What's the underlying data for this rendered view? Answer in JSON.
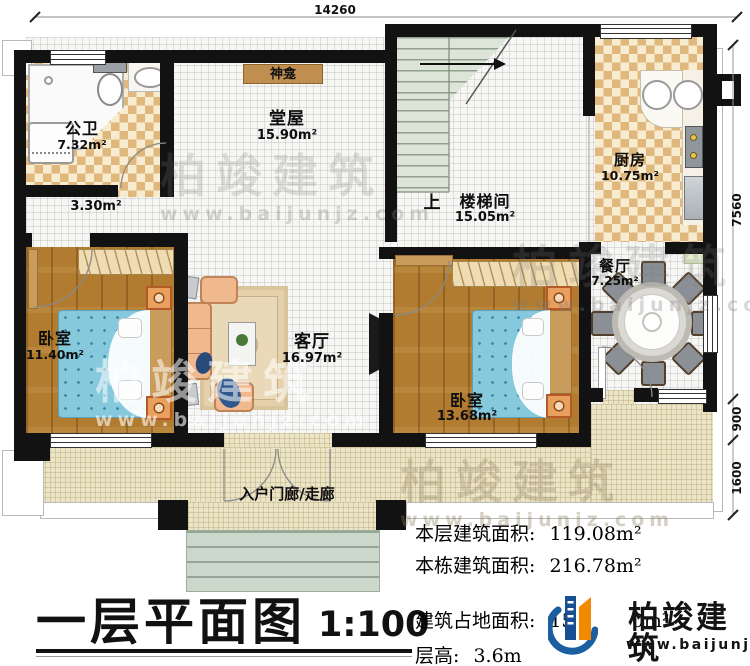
{
  "dimensions": {
    "top": "14260",
    "right_upper": "7560",
    "right_mid": "900",
    "right_lower": "1600"
  },
  "rooms": {
    "bathroom": {
      "name": "公卫",
      "area": "7.32m²"
    },
    "corridor": {
      "area": "3.30m²"
    },
    "hall": {
      "name": "堂屋",
      "area": "15.90m²"
    },
    "shrine": {
      "name": "神龛"
    },
    "stairwell": {
      "name": "楼梯间",
      "area": "15.05m²",
      "direction": "上"
    },
    "kitchen": {
      "name": "厨房",
      "area": "10.75m²"
    },
    "dining": {
      "name": "餐厅",
      "area": "7.25m²"
    },
    "bedroom_left": {
      "name": "卧室",
      "area": "11.40m²"
    },
    "living": {
      "name": "客厅",
      "area": "16.97m²"
    },
    "bedroom_right": {
      "name": "卧室",
      "area": "13.68m²"
    },
    "porch": {
      "name": "入户门廊/走廊"
    }
  },
  "title": {
    "text": "一层平面图",
    "scale": "1:100"
  },
  "stats": {
    "floor": {
      "label": "本层建筑面积:",
      "value": "119.08m²"
    },
    "building": {
      "label": "本栋建筑面积:",
      "value": "216.78m²"
    },
    "footprint": {
      "label": "建筑占地面积:",
      "value_prefix": "15",
      "value_suffix": "0m²"
    },
    "height": {
      "label": "层高:",
      "value": "3.6m"
    }
  },
  "brand": {
    "name": "柏竣建筑",
    "url": "www.baijunjz.com"
  },
  "colors": {
    "wall": "#121212",
    "checker_dark": "#e0b77c",
    "checker_light": "#f7eccf",
    "wood": "#b17c2f",
    "bed": "#86c9dd",
    "porch": "#ece4c7",
    "steps": "#cdd8cc",
    "stairs": "#dde4d8",
    "logo_blue": "#1b5fa0",
    "logo_orange": "#f28a00"
  }
}
